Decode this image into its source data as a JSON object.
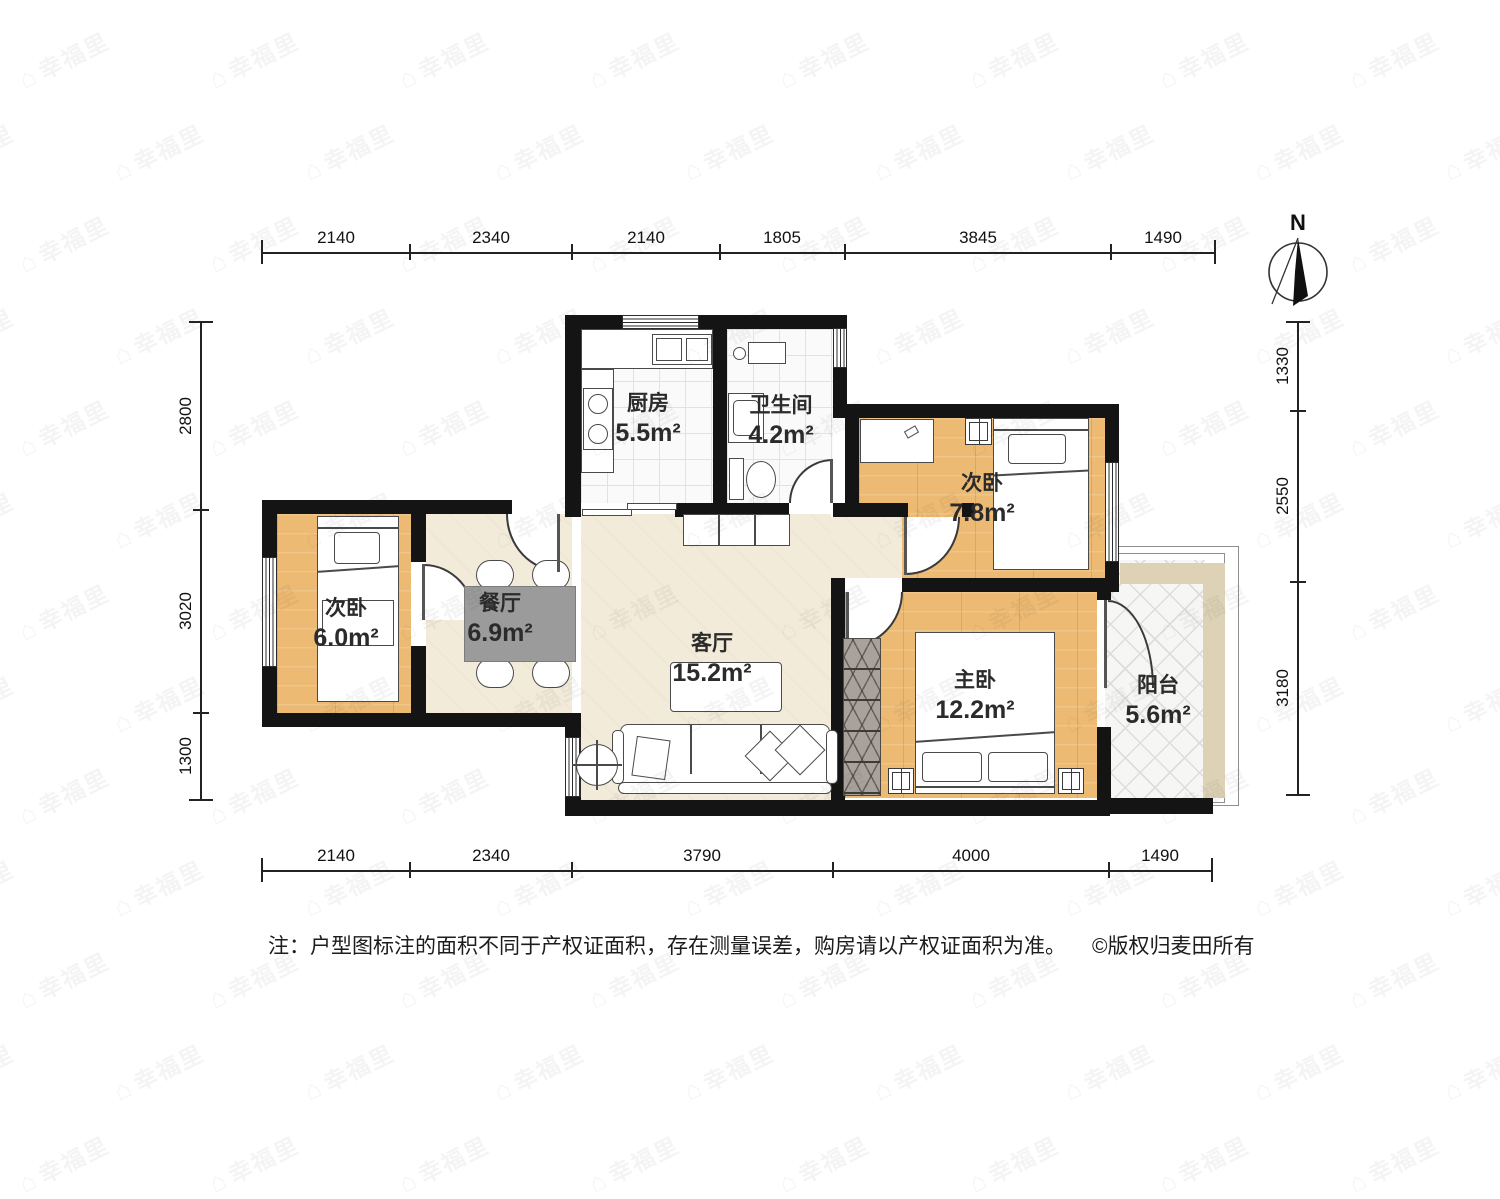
{
  "watermark": {
    "text": "幸福里",
    "icon": "house-icon"
  },
  "compass": {
    "label": "N"
  },
  "dimensions": {
    "top": [
      "2140",
      "2340",
      "2140",
      "1805",
      "3845",
      "1490"
    ],
    "bottom": [
      "2140",
      "2340",
      "3790",
      "4000",
      "1490"
    ],
    "left": [
      "2800",
      "3020",
      "1300"
    ],
    "right": [
      "1330",
      "2550",
      "3180"
    ]
  },
  "rooms": {
    "kitchen": {
      "name": "厨房",
      "area": "5.5m²"
    },
    "bathroom": {
      "name": "卫生间",
      "area": "4.2m²"
    },
    "bedroom_right": {
      "name": "次卧",
      "area": "7.8m²"
    },
    "bedroom_left": {
      "name": "次卧",
      "area": "6.0m²"
    },
    "dining": {
      "name": "餐厅",
      "area": "6.9m²"
    },
    "living": {
      "name": "客厅",
      "area": "15.2m²"
    },
    "master": {
      "name": "主卧",
      "area": "12.2m²"
    },
    "balcony": {
      "name": "阳台",
      "area": "5.6m²"
    }
  },
  "note": {
    "disclaimer": "注：户型图标注的面积不同于产权证面积，存在测量误差，购房请以产权证面积为准。",
    "copyright": "©版权归麦田所有"
  },
  "colors": {
    "wall": "#141414",
    "wood_floor": "#ecba72",
    "public_floor": "#f3ebda",
    "table": "#9b9b9b",
    "tan_strip": "#ddd2b6"
  }
}
